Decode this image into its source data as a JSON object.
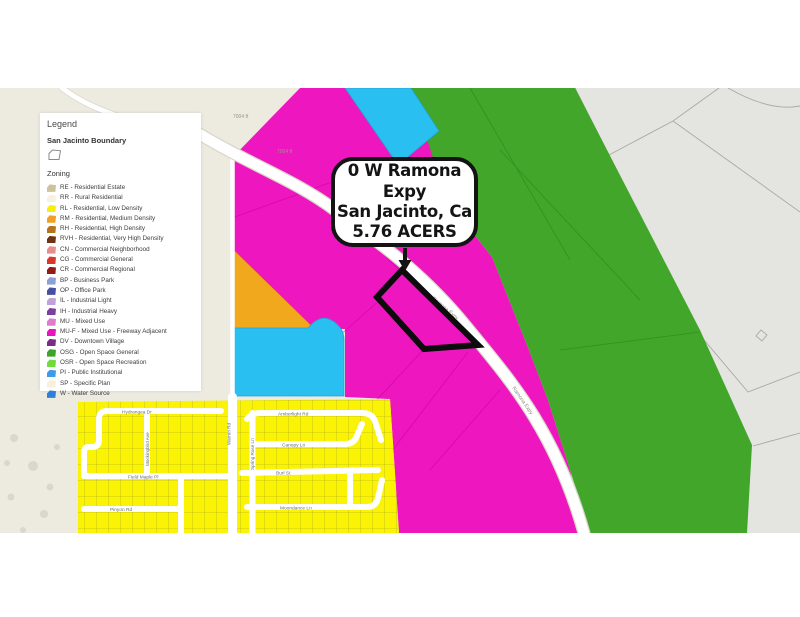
{
  "callout": {
    "line1": "0 W Ramona Expy",
    "line2": "San Jacinto, Ca",
    "line3": "5.76 ACERS"
  },
  "legend": {
    "title": "Legend",
    "boundary_heading": "San Jacinto Boundary",
    "boundary_icon": "polygon-outline-icon",
    "zoning_heading": "Zoning",
    "items": [
      {
        "code": "RE",
        "label": "RE - Residential Estate",
        "color": "#CDC39A"
      },
      {
        "code": "RR",
        "label": "RR - Rural Residential",
        "color": "#F7F2DF"
      },
      {
        "code": "RL",
        "label": "RL - Residential, Low Density",
        "color": "#F7EF0A"
      },
      {
        "code": "RM",
        "label": "RM - Residential, Medium Density",
        "color": "#EFA11F"
      },
      {
        "code": "RH",
        "label": "RH - Residential, High Density",
        "color": "#B5741C"
      },
      {
        "code": "RVH",
        "label": "RVH - Residential, Very High Density",
        "color": "#6E3414"
      },
      {
        "code": "CN",
        "label": "CN - Commercial Neighborhood",
        "color": "#E58F8F"
      },
      {
        "code": "CG",
        "label": "CG - Commercial General",
        "color": "#D8372A"
      },
      {
        "code": "CR",
        "label": "CR - Commercial Regional",
        "color": "#8F1D15"
      },
      {
        "code": "BP",
        "label": "BP - Business Park",
        "color": "#8E9FD6"
      },
      {
        "code": "OP",
        "label": "OP - Office Park",
        "color": "#46509E"
      },
      {
        "code": "IL",
        "label": "IL - Industrial Light",
        "color": "#BFA3D8"
      },
      {
        "code": "IH",
        "label": "IH - Industrial Heavy",
        "color": "#7C3F9E"
      },
      {
        "code": "MU",
        "label": "MU - Mixed Use",
        "color": "#DE7ECB"
      },
      {
        "code": "MU-F",
        "label": "MU-F - Mixed Use - Freeway Adjacent",
        "color": "#E716BC"
      },
      {
        "code": "DV",
        "label": "DV - Downtown Village",
        "color": "#7C2B86"
      },
      {
        "code": "OSG",
        "label": "OSG - Open Space General",
        "color": "#3FA32A"
      },
      {
        "code": "OSR",
        "label": "OSR - Open Space Recreation",
        "color": "#6EDC3A"
      },
      {
        "code": "PI",
        "label": "PI - Public Institutional",
        "color": "#3D9BE9"
      },
      {
        "code": "SP",
        "label": "SP - Specific Plan",
        "color": "#F6F1DE"
      },
      {
        "code": "W",
        "label": "W - Water Source",
        "color": "#2F7FD6"
      }
    ]
  },
  "map": {
    "road_label": "Ramona Expy",
    "distance_label": "7004 ft",
    "streets": [
      "Hydrangea Dr",
      "Field Maple Pl",
      "Pinyon Rd",
      "Amberlight Rd",
      "Canopy Ln",
      "Burl St",
      "Moondance Ln",
      "Mockingbird Ave",
      "Spring Rose Ln",
      "Warren Rd"
    ],
    "zone_colors": {
      "magenta": "#EE16BE",
      "green": "#41A62A",
      "cyan": "#29BFF0",
      "orange": "#F2A81D",
      "yellow": "#FAF303",
      "background": "#EDEAE0",
      "gray_parcels": "#E4E4E1"
    }
  }
}
